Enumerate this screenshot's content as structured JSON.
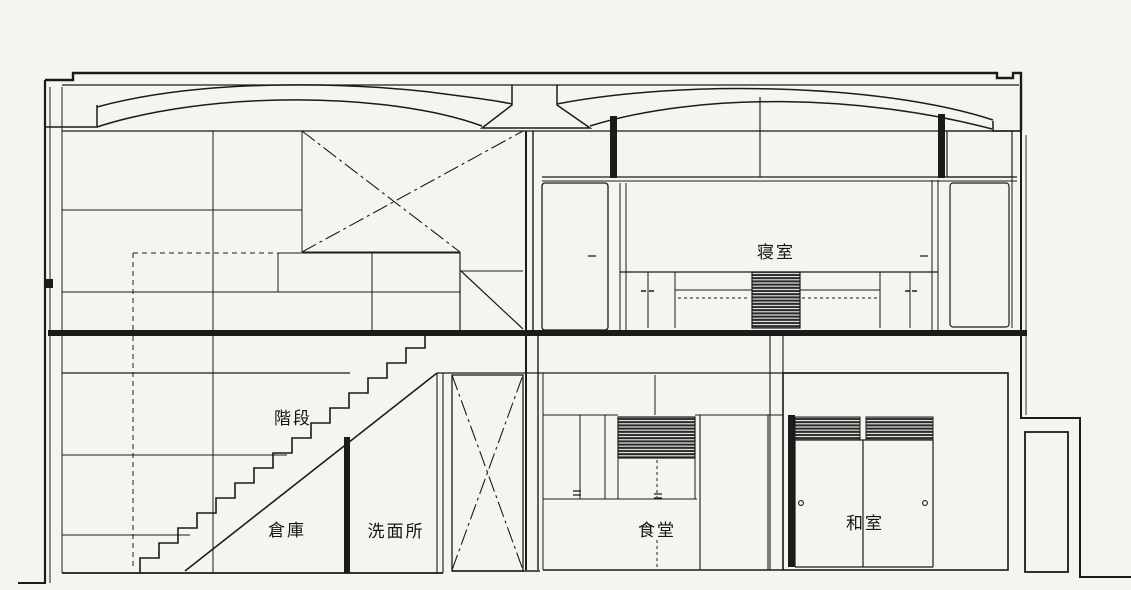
{
  "drawing": {
    "kind": "architectural-cross-section",
    "background_color": "#f5f4ef",
    "ink_color": "#1b1b1b",
    "labels": {
      "bedroom": "寝室",
      "stairs": "階段",
      "storage": "倉庫",
      "washroom": "洗面所",
      "dining": "食堂",
      "japanese_room": "和室"
    }
  }
}
